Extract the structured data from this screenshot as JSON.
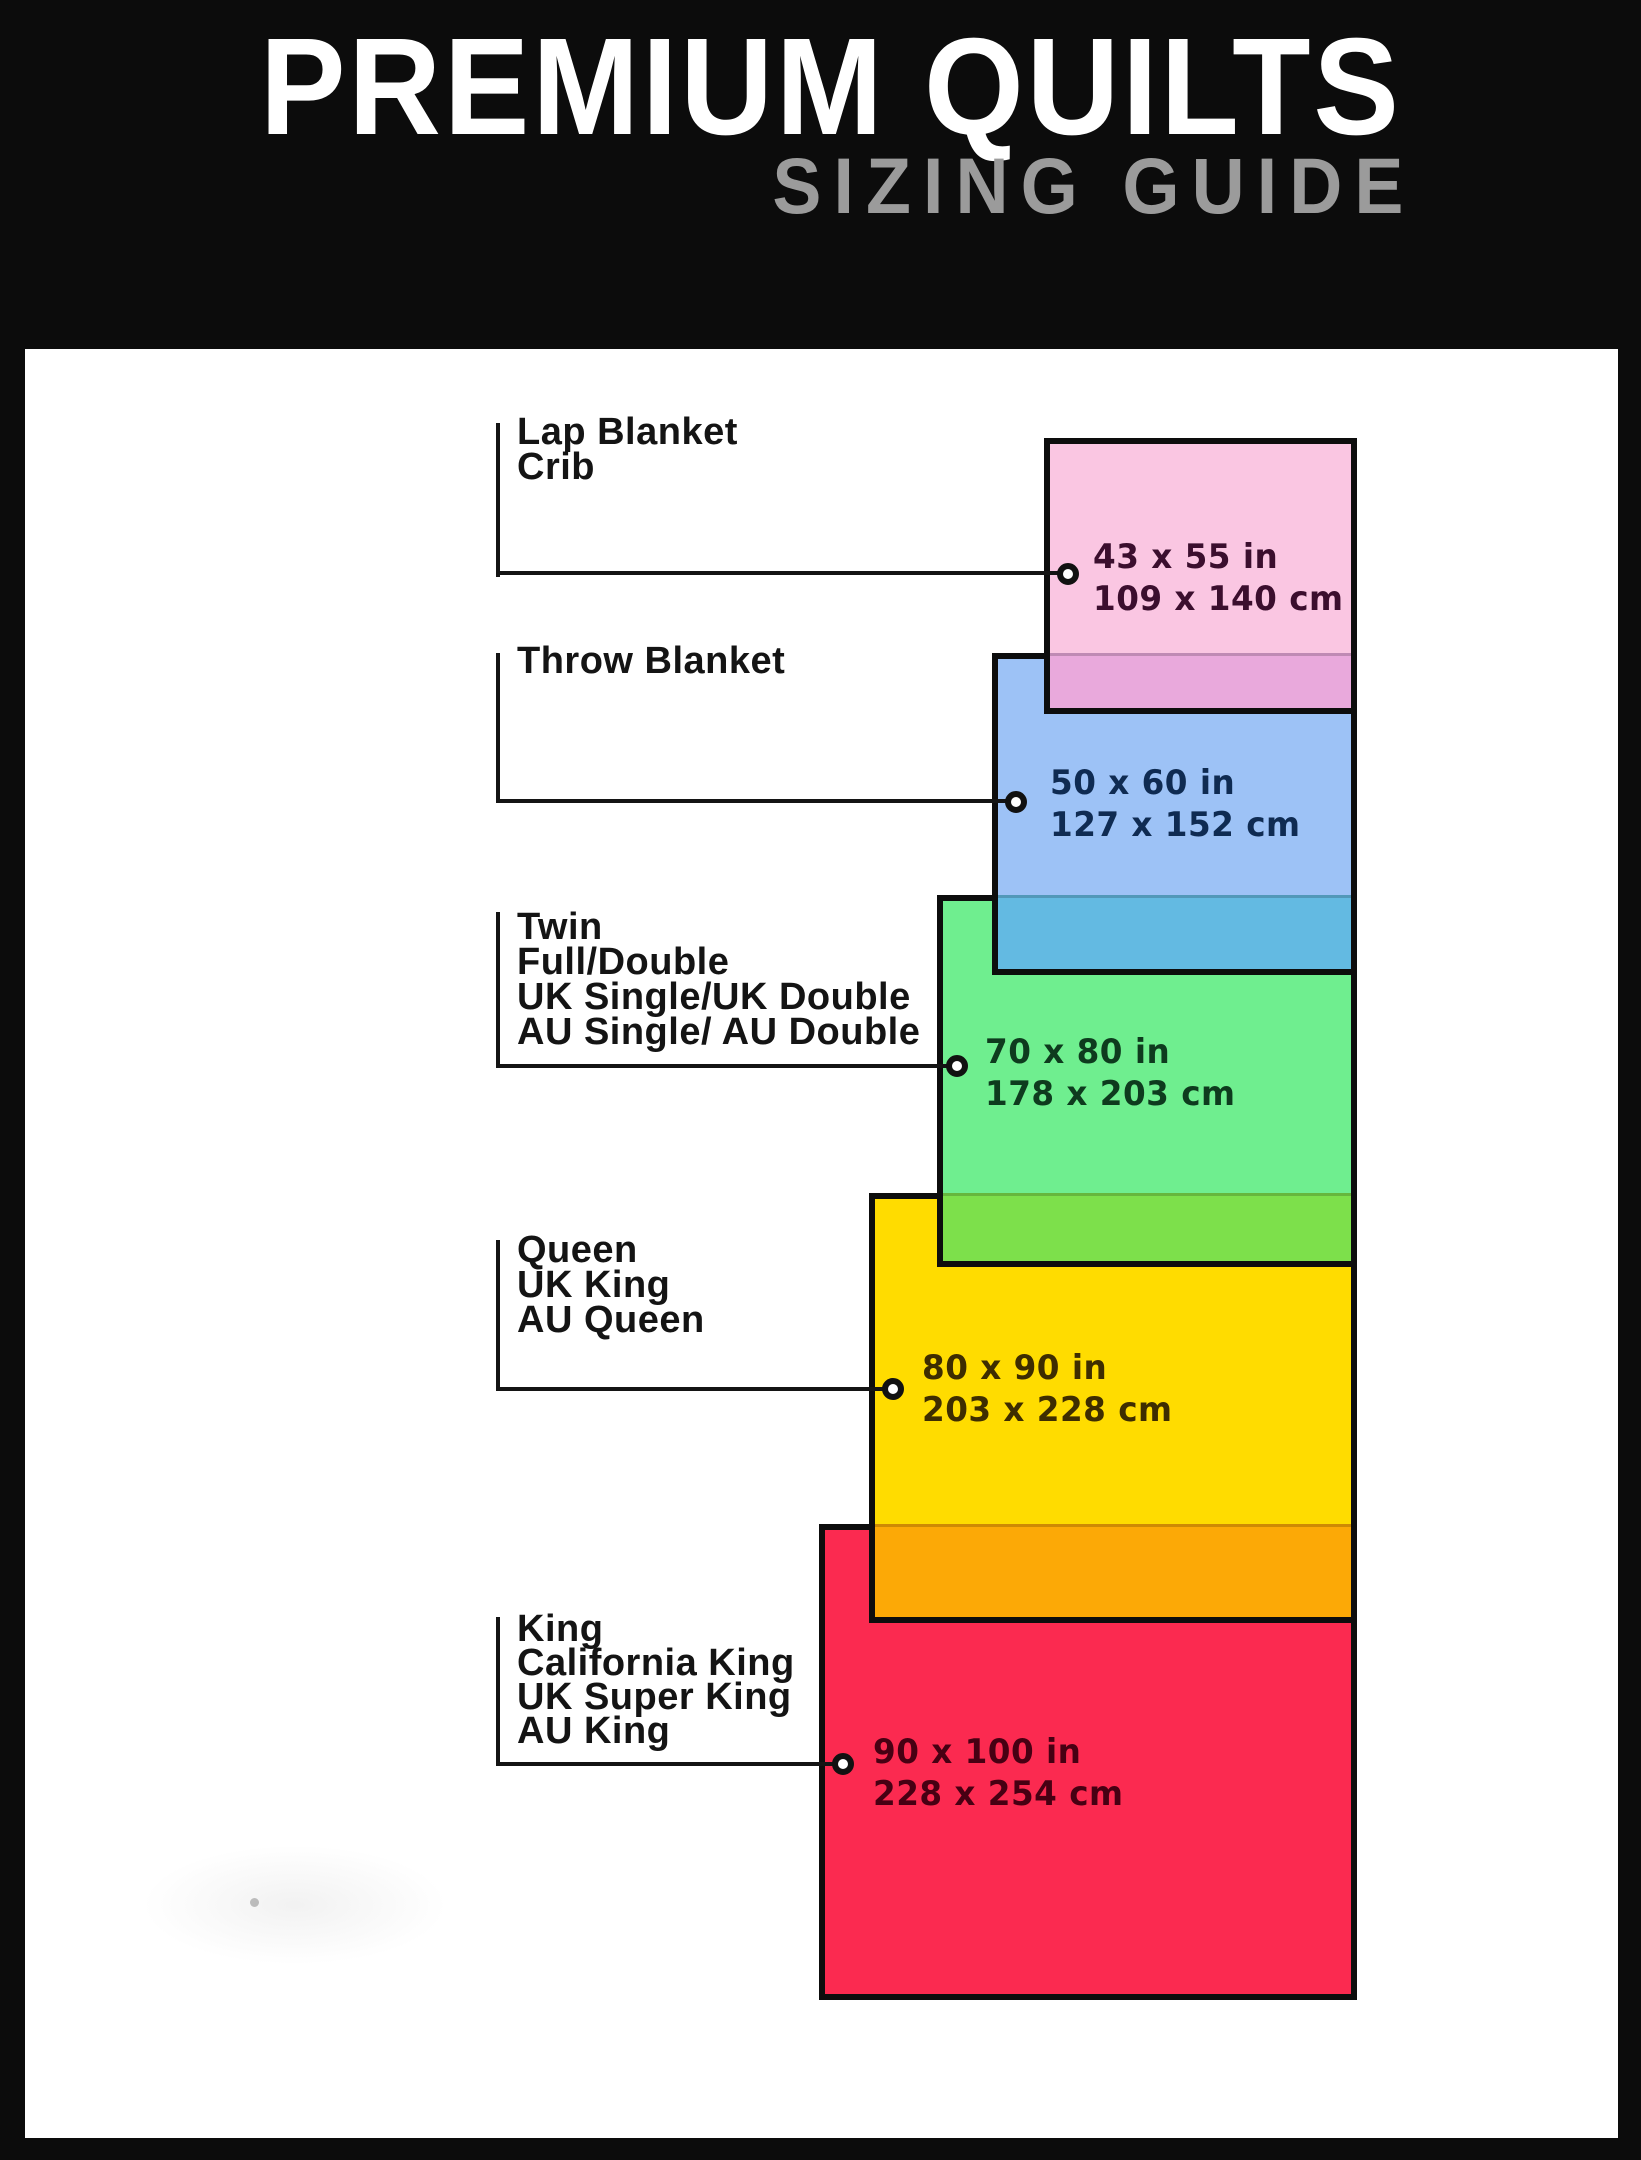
{
  "header": {
    "title": "PREMIUM QUILTS",
    "subtitle": "SIZING GUIDE"
  },
  "palette": {
    "frame_black": "#0c0c0c",
    "title_white": "#ffffff",
    "subtitle_gray": "#9b9b9b",
    "label_text": "#141414",
    "leader_line": "#141414"
  },
  "sizes": [
    {
      "name": "lap-blanket-crib",
      "labels": [
        "Lap Blanket",
        "Crib"
      ],
      "size_in": "43 x 55 in",
      "size_cm": "109 x 140 cm",
      "fill": "#FAC6E2",
      "overlap_fill": "#E9A9DC",
      "text_color": "#3B0E2E"
    },
    {
      "name": "throw-blanket",
      "labels": [
        "Throw Blanket"
      ],
      "size_in": "50 x 60 in",
      "size_cm": "127 x 152 cm",
      "fill": "#9DC2F6",
      "overlap_fill": "#63BAE2",
      "text_color": "#0F2B52"
    },
    {
      "name": "twin-full-double",
      "labels": [
        "Twin",
        "Full/Double",
        "UK Single/UK Double",
        "AU Single/ AU Double"
      ],
      "size_in": "70 x 80 in",
      "size_cm": "178 x 203 cm",
      "fill": "#6FEE8F",
      "overlap_fill": "#7DE04B",
      "text_color": "#0E3B1E"
    },
    {
      "name": "queen",
      "labels": [
        "Queen",
        "UK King",
        "AU Queen"
      ],
      "size_in": "80 x 90 in",
      "size_cm": "203 x 228 cm",
      "fill": "#FFDC00",
      "overlap_fill": "#FCA906",
      "text_color": "#3E2D00"
    },
    {
      "name": "king",
      "labels": [
        "King",
        "California King",
        "UK Super King",
        "AU King"
      ],
      "size_in": "90 x 100 in",
      "size_cm": "228 x 254 cm",
      "fill": "#FB2A50",
      "overlap_fill": null,
      "text_color": "#470013"
    }
  ]
}
